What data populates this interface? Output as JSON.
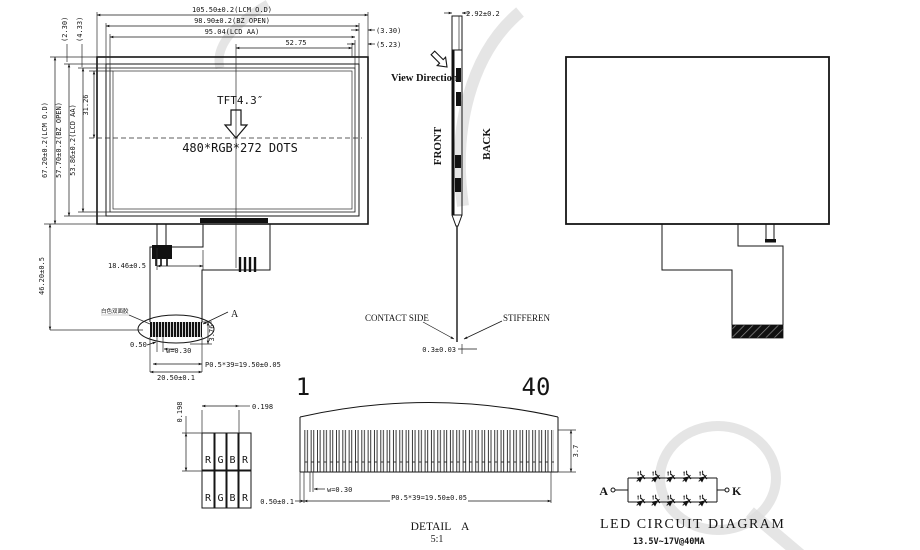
{
  "drawing": {
    "front_view": {
      "dims_top": [
        "105.50±0.2(LCM O.D)",
        "98.90±0.2(BZ OPEN)",
        "95.04(LCD AA)",
        "52.75"
      ],
      "dims_top_right": [
        "(3.30)",
        "(5.23)"
      ],
      "dims_top_left_rotated": [
        "(2.30)",
        "(4.33)"
      ],
      "dims_left": [
        "67.20±0.2(LCM O.D)",
        "57.70±0.2(BZ OPEN)",
        "53.86±0.2(LCD AA)",
        "31.26"
      ],
      "dim_height_bottom": "46.20±0.5",
      "dim_fpc_offset": "18.46±0.5",
      "screen_type": "TFT4.3″",
      "resolution": "480*RGB*272 DOTS",
      "connector": {
        "note": "白色双面胶",
        "dim_offset": "0.50",
        "dim_width": "w=0.30",
        "dim_height": "3.76",
        "dim_pitch": "P0.5*39=19.50±0.05",
        "dim_total": "20.50±0.1",
        "detail_ref": "A"
      }
    },
    "side_view": {
      "dim_thickness": "2.92±0.2",
      "view_direction": "View Direction",
      "front_label": "FRONT",
      "back_label": "BACK",
      "contact_label": "CONTACT SIDE",
      "stiffener_label": "STIFFEREN",
      "dim_fpc_thickness": "0.3±0.03"
    },
    "pixel_detail": {
      "dim_vertical": "0.198",
      "dim_horizontal": "0.198",
      "rows": [
        [
          "R",
          "G",
          "B",
          "R"
        ],
        [
          "R",
          "G",
          "B",
          "R"
        ]
      ]
    },
    "detail_a": {
      "pin_first": "1",
      "pin_last": "40",
      "dim_offset": "0.50±0.1",
      "dim_width": "w=0.30",
      "dim_pitch": "P0.5*39=19.50±0.05",
      "dim_height": "3.7",
      "title": "DETAIL A",
      "scale": "5:1"
    },
    "led_circuit": {
      "anode": "A",
      "cathode": "K",
      "title": "LED CIRCUIT DIAGRAM",
      "spec": "13.5V~17V@40MA"
    }
  }
}
